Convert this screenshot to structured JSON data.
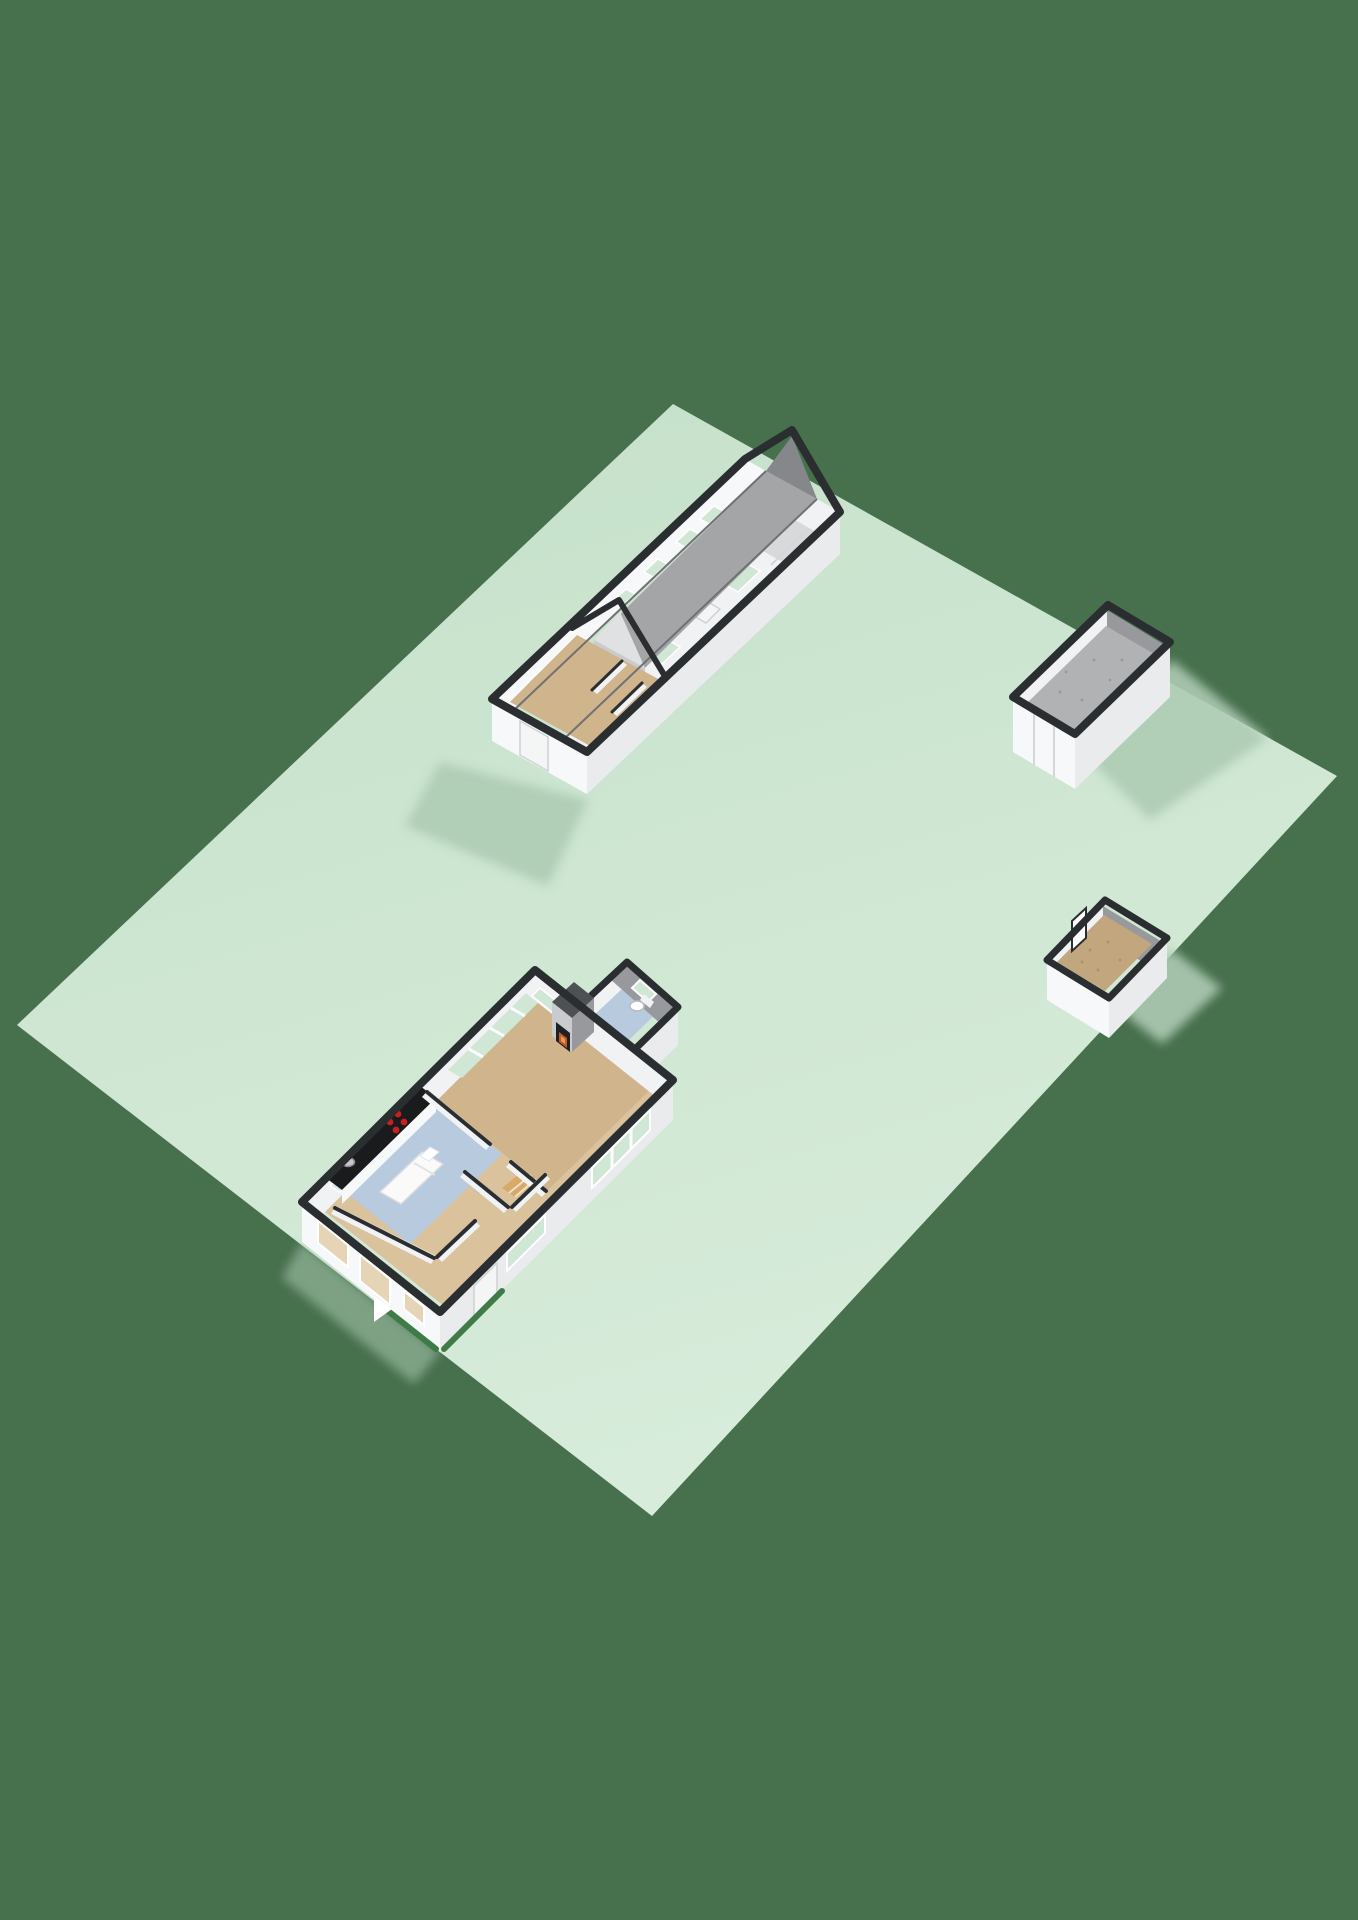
{
  "scene": {
    "title": "3D floorplan site view — lawn parcel with house, workshop barn, garage and garden shed (no visible text in render)",
    "background_color": "#47704D",
    "palette": {
      "bg": "#47704D",
      "parcel": "#C4E0C9",
      "parcel_light": "#D7ECDA",
      "shadow": "#AECBB4",
      "cap": "#2B2E31",
      "wall_white": "#F7F8F9",
      "wall_shade": "#EAEBED",
      "wall_dim": "#DFE1E3",
      "inner_light": "#F1F2F3",
      "inner_gray": "#97999D",
      "inner_gray_dark": "#85878A",
      "roof_gray": "#A4A5A7",
      "roof_gray2": "#9B9C9E",
      "floor_tan": "#CFB48C",
      "floor_tan_light": "#DAC29D",
      "floor_gray": "#B1B2B4",
      "floor_blue": "#B7CADE",
      "floor_shed": "#C2A67D",
      "glass_green": "#CFE7D4",
      "glass_blue": "#DCE7EF",
      "glass_tan": "#E6D4B6",
      "frame_white": "#FFFFFF",
      "door_white": "#F4F5F5",
      "roller_gray": "#D7D9DB",
      "counter_black": "#191B1D",
      "burner_red": "#C8201B",
      "steel_gray": "#C6C8CA",
      "fire_box": "#1E2123",
      "flame_orange": "#C4572B",
      "flame_bright": "#E89A4B",
      "chimney_gray": "#C9CBCE",
      "chimney_cap": "#4E5154",
      "hedge_green": "#3F7B46",
      "step_wood": "#D9A967",
      "bed_white": "#FAFAFB"
    },
    "parcel": {
      "kind": "lawn lot, rotated quadrilateral"
    },
    "structures": [
      {
        "id": "workshop-barn",
        "position": "top",
        "open_top": true,
        "features": [
          "gabled end wall",
          "gray hall floor",
          "green glazed windows",
          "roller door",
          "side door",
          "divided storage rooms with tan floors"
        ]
      },
      {
        "id": "garage",
        "position": "upper-right",
        "open_top": true,
        "features": [
          "tall white box",
          "gray interior",
          "double door seams"
        ]
      },
      {
        "id": "garden-shed",
        "position": "right",
        "open_top": true,
        "features": [
          "tan speckled floor",
          "door ajar"
        ]
      },
      {
        "id": "house",
        "position": "lower-left",
        "open_top": true,
        "rooms": [
          "living-room",
          "kitchen-bedroom",
          "bedroom",
          "hallway",
          "bathroom",
          "annex-bathroom"
        ],
        "fixtures": [
          "fireplace",
          "chimney",
          "hob-4-burners",
          "sink",
          "counter",
          "bed",
          "toilet",
          "toilet-annex",
          "entry-steps",
          "glazed-sliding-doors",
          "hedge-strips",
          "entrance-arrow"
        ]
      }
    ]
  }
}
